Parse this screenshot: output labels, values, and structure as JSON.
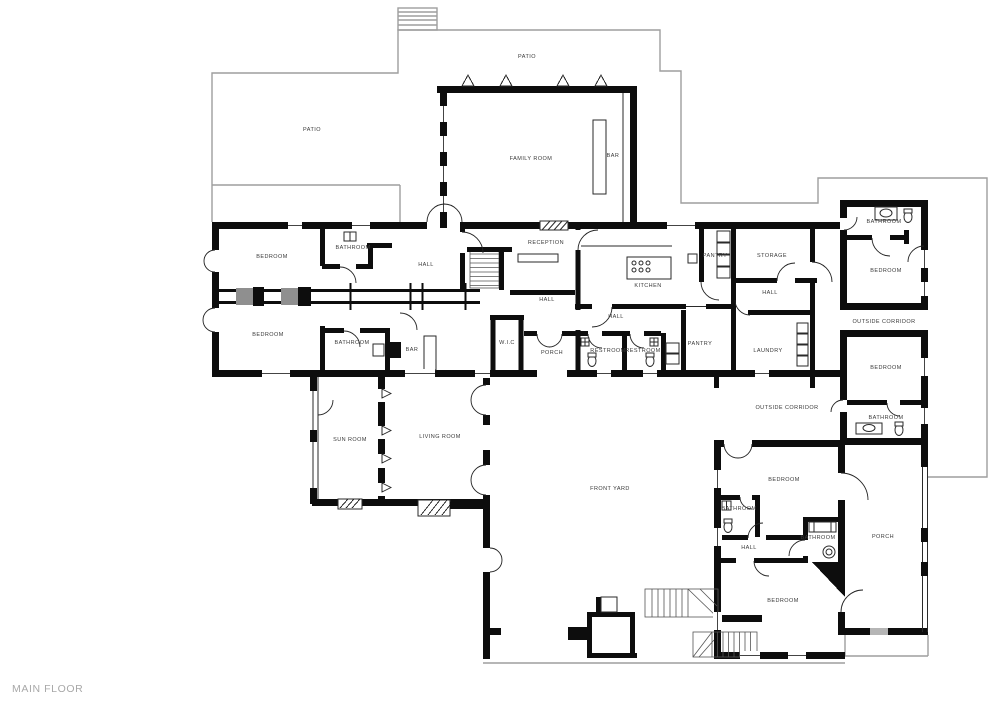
{
  "plan_title": "MAIN FLOOR",
  "colors": {
    "wall": "#0d0d0d",
    "outline": "#a6a6a6",
    "label_text": "#3a3a3a",
    "title_text": "#a8a8a8",
    "closet_fill": "#8f8f8f"
  },
  "floorplan": {
    "labels": [
      {
        "text": "PATIO",
        "x": 527,
        "y": 57
      },
      {
        "text": "PATIO",
        "x": 312,
        "y": 130
      },
      {
        "text": "FAMILY ROOM",
        "x": 531,
        "y": 159
      },
      {
        "text": "BAR",
        "x": 613,
        "y": 156
      },
      {
        "text": "RECEPTION",
        "x": 546,
        "y": 243
      },
      {
        "text": "BEDROOM",
        "x": 272,
        "y": 257
      },
      {
        "text": "BATHROOM",
        "x": 353,
        "y": 248
      },
      {
        "text": "HALL",
        "x": 426,
        "y": 265
      },
      {
        "text": "KITCHEN",
        "x": 648,
        "y": 286
      },
      {
        "text": "PANTRY",
        "x": 715,
        "y": 256
      },
      {
        "text": "STORAGE",
        "x": 772,
        "y": 256
      },
      {
        "text": "HALL",
        "x": 770,
        "y": 293
      },
      {
        "text": "BATHROOM",
        "x": 884,
        "y": 222
      },
      {
        "text": "BEDROOM",
        "x": 886,
        "y": 271
      },
      {
        "text": "OUTSIDE CORRIDOR",
        "x": 884,
        "y": 322
      },
      {
        "text": "BEDROOM",
        "x": 268,
        "y": 335
      },
      {
        "text": "BATHROOM",
        "x": 352,
        "y": 343
      },
      {
        "text": "BAR",
        "x": 412,
        "y": 350
      },
      {
        "text": "HALL",
        "x": 547,
        "y": 300
      },
      {
        "text": "W.I.C",
        "x": 507,
        "y": 343
      },
      {
        "text": "PORCH",
        "x": 552,
        "y": 353
      },
      {
        "text": "HALL",
        "x": 616,
        "y": 317
      },
      {
        "text": "RESTROOM",
        "x": 608,
        "y": 351
      },
      {
        "text": "RESTROOM",
        "x": 643,
        "y": 351
      },
      {
        "text": "PANTRY",
        "x": 700,
        "y": 344
      },
      {
        "text": "LAUNDRY",
        "x": 768,
        "y": 351
      },
      {
        "text": "BEDROOM",
        "x": 886,
        "y": 368
      },
      {
        "text": "BATHROOM",
        "x": 886,
        "y": 418
      },
      {
        "text": "OUTSIDE CORRIDOR",
        "x": 787,
        "y": 408
      },
      {
        "text": "SUN ROOM",
        "x": 350,
        "y": 440
      },
      {
        "text": "LIVING ROOM",
        "x": 440,
        "y": 437
      },
      {
        "text": "FRONT YARD",
        "x": 610,
        "y": 489
      },
      {
        "text": "BEDROOM",
        "x": 784,
        "y": 480
      },
      {
        "text": "BATHROOM",
        "x": 739,
        "y": 509
      },
      {
        "text": "BATHROOM",
        "x": 818,
        "y": 538
      },
      {
        "text": "HALL",
        "x": 749,
        "y": 548
      },
      {
        "text": "PORCH",
        "x": 883,
        "y": 537
      },
      {
        "text": "BEDROOM",
        "x": 783,
        "y": 601
      }
    ]
  }
}
